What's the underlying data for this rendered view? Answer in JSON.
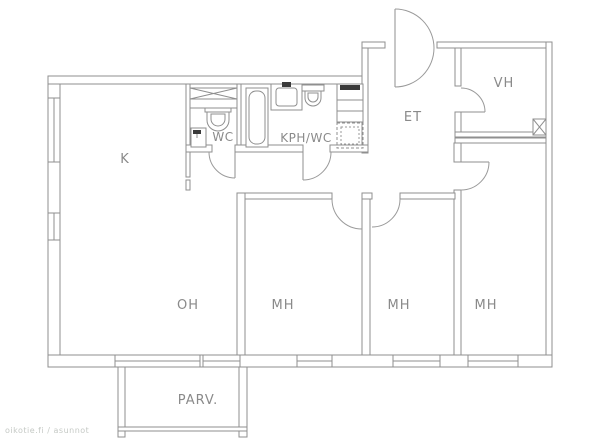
{
  "title": "apartment-floor-plan",
  "watermark": "oikotie.fi / asunnot",
  "colors": {
    "line": "#8f8f8f",
    "text": "#8a8a8a",
    "background": "#ffffff",
    "watermark": "#c5c9c5"
  },
  "rooms": [
    {
      "id": "k",
      "label": "K"
    },
    {
      "id": "wc",
      "label": "WC"
    },
    {
      "id": "kph-wc",
      "label": "KPH/WC"
    },
    {
      "id": "et",
      "label": "ET"
    },
    {
      "id": "vh",
      "label": "VH"
    },
    {
      "id": "oh",
      "label": "OH"
    },
    {
      "id": "mh-1",
      "label": "MH"
    },
    {
      "id": "mh-2",
      "label": "MH"
    },
    {
      "id": "mh-3",
      "label": "MH"
    },
    {
      "id": "parv",
      "label": "PARV."
    }
  ]
}
